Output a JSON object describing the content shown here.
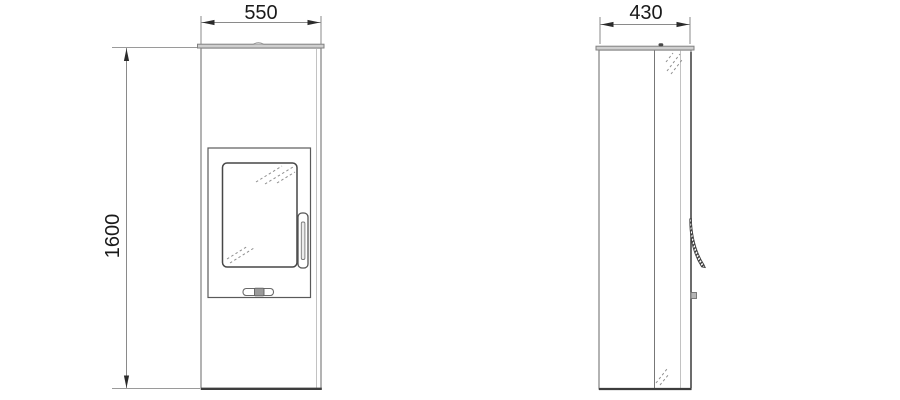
{
  "drawing": {
    "front_view": {
      "width_label": "550",
      "height_label": "1600"
    },
    "side_view": {
      "depth_label": "430"
    }
  },
  "colors": {
    "background": "#ffffff",
    "outline_dark": "#3d3d3d",
    "outline_medium": "#8a8a8a",
    "outline_light": "#c2c2c2",
    "plate_fill": "#cfcfcf",
    "handle_hatch": "#3a3a3a",
    "dimension_text": "#1a1a1a"
  }
}
